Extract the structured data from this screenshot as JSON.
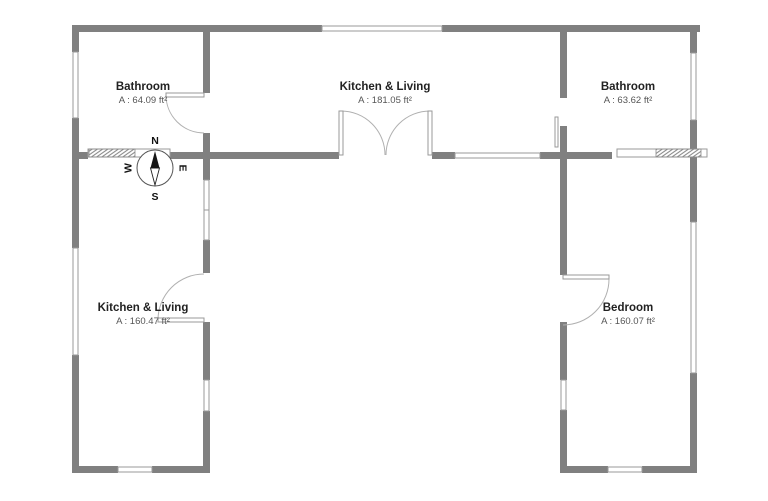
{
  "palette": {
    "wall": "#808080",
    "window_stroke": "#9a9a9a",
    "door_stroke": "#b0b0b0",
    "room_name_color": "#222222",
    "room_area_color": "#555555",
    "background": "#ffffff"
  },
  "rooms": [
    {
      "name": "Bathroom",
      "area": "A : 64.09 ft²"
    },
    {
      "name": "Kitchen & Living",
      "area": "A : 181.05 ft²"
    },
    {
      "name": "Bathroom",
      "area": "A : 63.62 ft²"
    },
    {
      "name": "Kitchen & Living",
      "area": "A : 160.47 ft²"
    },
    {
      "name": "Bedroom",
      "area": "A : 160.07 ft²"
    }
  ],
  "compass": {
    "north": "N",
    "south": "S",
    "east": "E",
    "west": "W"
  }
}
